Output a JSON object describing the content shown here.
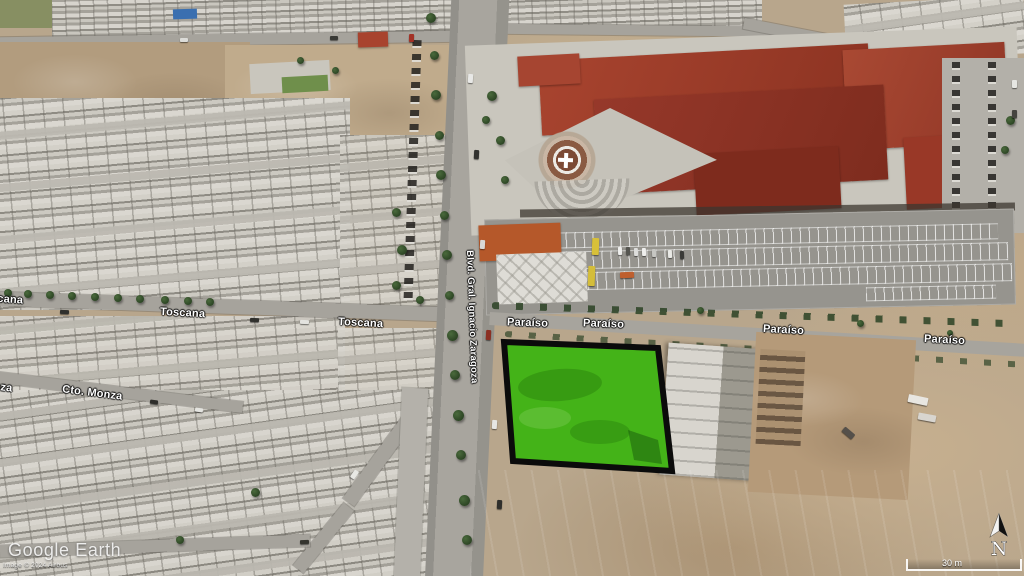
{
  "app": {
    "watermark": "Google Earth",
    "attribution": "Image © 2024 Airbus"
  },
  "map": {
    "streets": {
      "toscana": "Toscana",
      "cto_monza": "Cto. Monza",
      "blvd_zaragoza": "Blvd. Gral. Ignacio Zaragoza",
      "paraiso": "Paraíso"
    },
    "highlight": {
      "fill": "#44b318",
      "border": "#0b0b0b"
    }
  },
  "hud": {
    "scale_label": "30 m",
    "north_label": "N"
  }
}
